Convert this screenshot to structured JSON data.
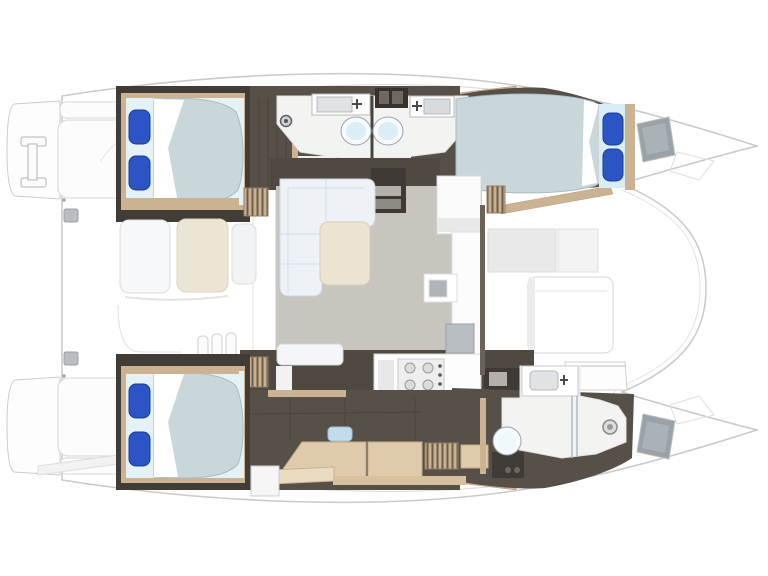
{
  "plan": {
    "type": "catamaran-interior-floor-plan",
    "orientation": "bow-right-stern-left",
    "areas": [
      {
        "id": "port-aft-cabin",
        "name": "double-berth-cabin-aft-port"
      },
      {
        "id": "port-bathroom-aft",
        "name": "head-with-sink-and-toilet"
      },
      {
        "id": "port-bathroom-fwd",
        "name": "head-with-sink-and-toilet"
      },
      {
        "id": "port-forward-cabin",
        "name": "double-berth-cabin-forward-port"
      },
      {
        "id": "saloon",
        "name": "saloon-with-l-sofa-table-galley"
      },
      {
        "id": "aft-cockpit",
        "name": "cockpit-bench-seating"
      },
      {
        "id": "foredeck",
        "name": "foredeck-lounge"
      },
      {
        "id": "starboard-aft-cabin",
        "name": "double-berth-cabin-aft-starboard"
      },
      {
        "id": "starboard-corridor",
        "name": "desk-and-storage-corridor"
      },
      {
        "id": "starboard-bathroom",
        "name": "head-with-shower-forward"
      },
      {
        "id": "swim-platforms",
        "name": "transom-steps-and-davit"
      }
    ],
    "counts": {
      "berths": 3,
      "toilets": 3,
      "sinks": 4,
      "stove_burners": 4,
      "blue_pillows": 6
    }
  },
  "colors": {
    "deck_white": "#ffffff",
    "outline_grey": "#c9c9c9",
    "faint_grey": "#e2e2e2",
    "hull_dark": "#575048",
    "cabin_dark": "#423c37",
    "band_dark": "#4f4942",
    "steps_dark": "#3f3a35",
    "hatch_dark": "#35312d",
    "wood_trim": "#cbb293",
    "wood_light": "#dfcbab",
    "saloon_floor": "#c8c5bf",
    "sofa_white": "#eef2f7",
    "sofa_line": "#ccd6e2",
    "table_cream": "#ece4d2",
    "cushion_cream": "#ece5d5",
    "cushion_white": "#f7f8f9",
    "bed_duvet": "#c9d7da",
    "duvet_edge": "#a9bcc2",
    "sheet_white": "#ffffff",
    "pillow_blue": "#2b55c4",
    "pillow_base": "#d9edf7",
    "toilet_seat": "#d9eef5",
    "hatch_grey": "#9aa2a8",
    "appliance_grey": "#b9bec2",
    "tread_grey": "#b3afa9",
    "basin_grey": "#dfe3e5",
    "sink_grey": "#aeb4b8",
    "glass_blue": "#a9bcc6",
    "bathroom_floor": "#f3f3f2",
    "louver_tan": "#c9b08f",
    "louver_slat": "#6b5e4e"
  }
}
